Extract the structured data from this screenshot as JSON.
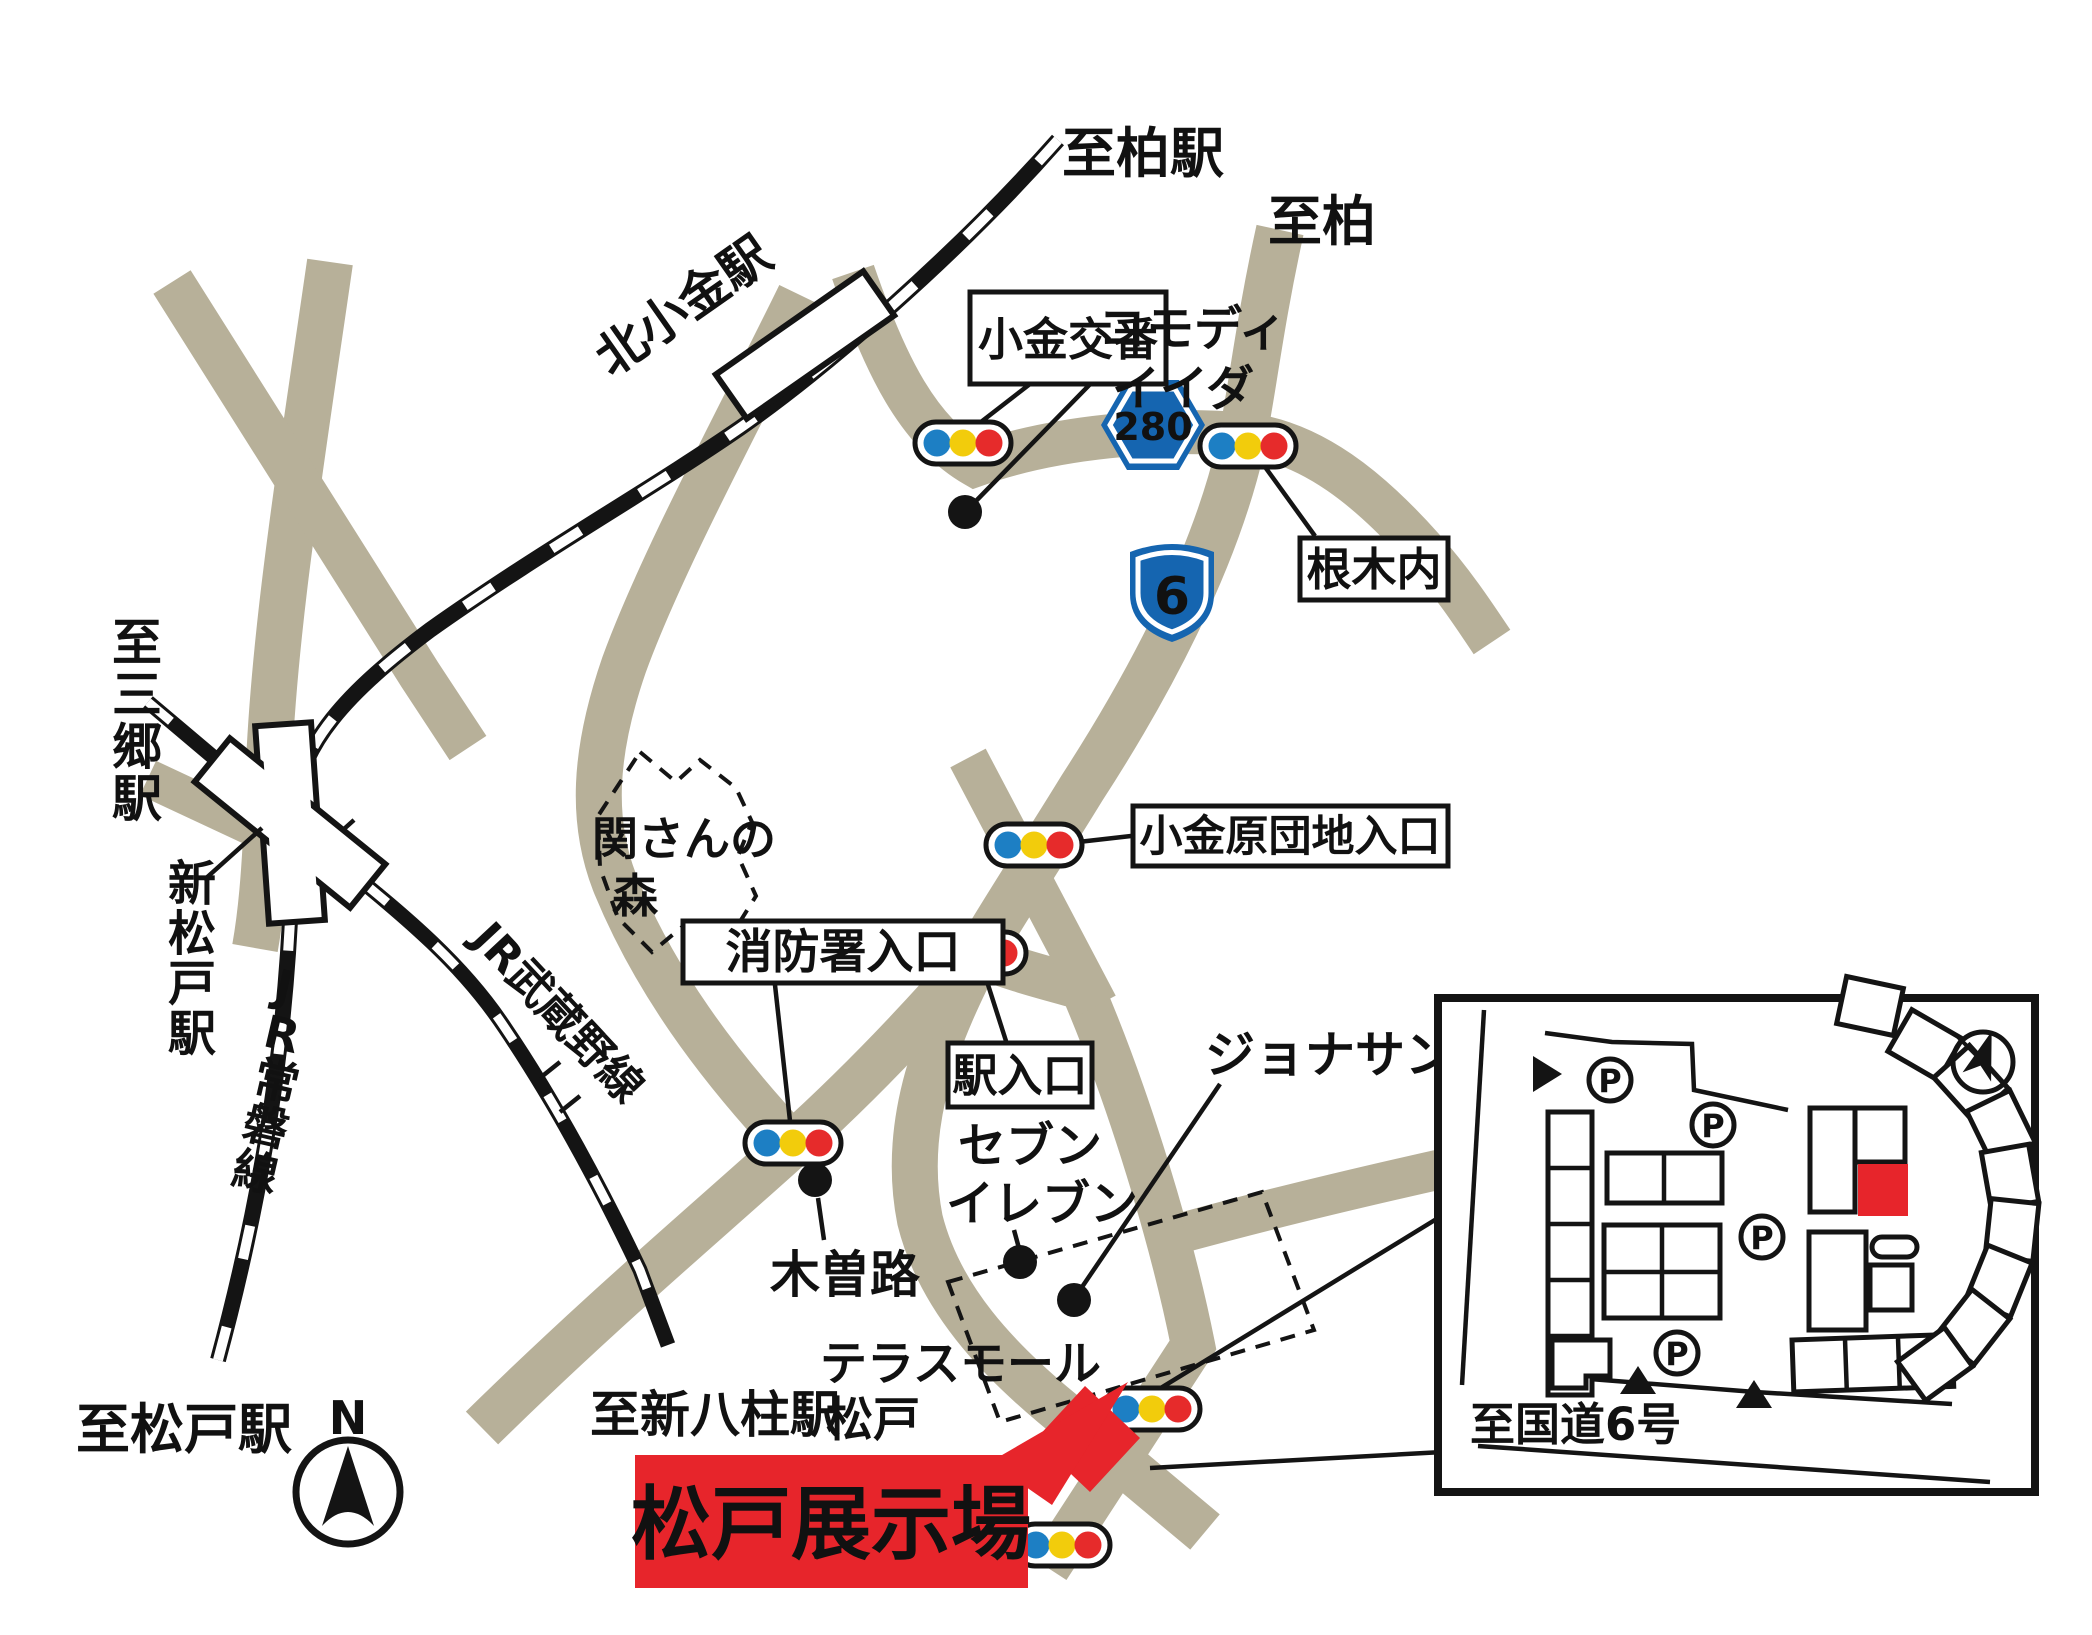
{
  "colors": {
    "road": "#b7b099",
    "rail": "#141414",
    "signal_blue": "#1d7fc4",
    "signal_yellow": "#f2cc0c",
    "signal_red": "#e62b2b",
    "badge_blue": "#1565b0",
    "banner_red": "#e7252b"
  },
  "destinations": {
    "kashiwa_sta": "至柏駅",
    "kashiwa": "至柏",
    "misato_sta": "至三郷駅",
    "matsudo_sta": "至松戸駅",
    "shin_yahashira_sta": "至新八柱駅",
    "kokudo6": "至国道6号"
  },
  "stations": {
    "kita_kogane": "北小金駅",
    "shin_matsudo": "新松戸駅"
  },
  "rail_lines": {
    "joban": "JR常磐線",
    "musashino": "JR武蔵野線"
  },
  "boxed_labels": {
    "koban": "小金交番",
    "negiuchi": "根木内",
    "koganehara": "小金原団地入口",
    "fire_station": "消防署入口",
    "station_entrance": "駅入口"
  },
  "poi": {
    "commodi_line1": "コモディ",
    "commodi_line2": "イイダ",
    "jonathan": "ジョナサン",
    "seven_line1": "セブン",
    "seven_line2": "イレブン",
    "kisoji": "木曽路",
    "terrace_line1": "テラスモール",
    "terrace_line2": "松戸",
    "seki_forest_line1": "関さんの",
    "seki_forest_line2": "森"
  },
  "route_badges": {
    "r280": "280",
    "r6": "6"
  },
  "site": {
    "banner": "松戸展示場"
  },
  "compass": {
    "north": "N"
  },
  "inset": {
    "parking": "P"
  }
}
